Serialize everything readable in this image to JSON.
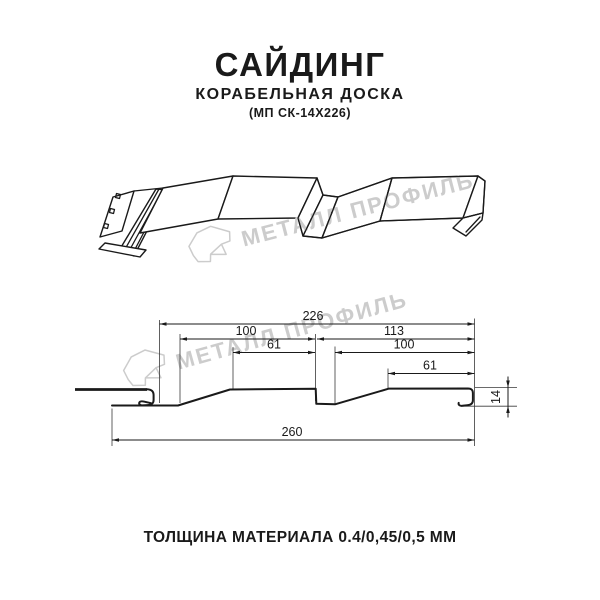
{
  "header": {
    "title": "САЙДИНГ",
    "subtitle": "КОРАБЕЛЬНАЯ ДОСКА",
    "product_code": "(МП СК-14Х226)"
  },
  "watermark": {
    "brand": "МЕТАЛЛ ПРОФИЛЬ"
  },
  "section": {
    "dims": {
      "overall_top": "226",
      "left_width": "100",
      "right_width": "113",
      "left_flat": "61",
      "right_flat_width": "100",
      "right_flat": "61",
      "overall_bottom": "260",
      "profile_height": "14"
    }
  },
  "footer": {
    "thickness": "ТОЛЩИНА МАТЕРИАЛА 0.4/0,45/0,5 ММ"
  },
  "colors": {
    "line": "#1a1a1a",
    "watermark": "#cccccc",
    "background": "#ffffff"
  }
}
